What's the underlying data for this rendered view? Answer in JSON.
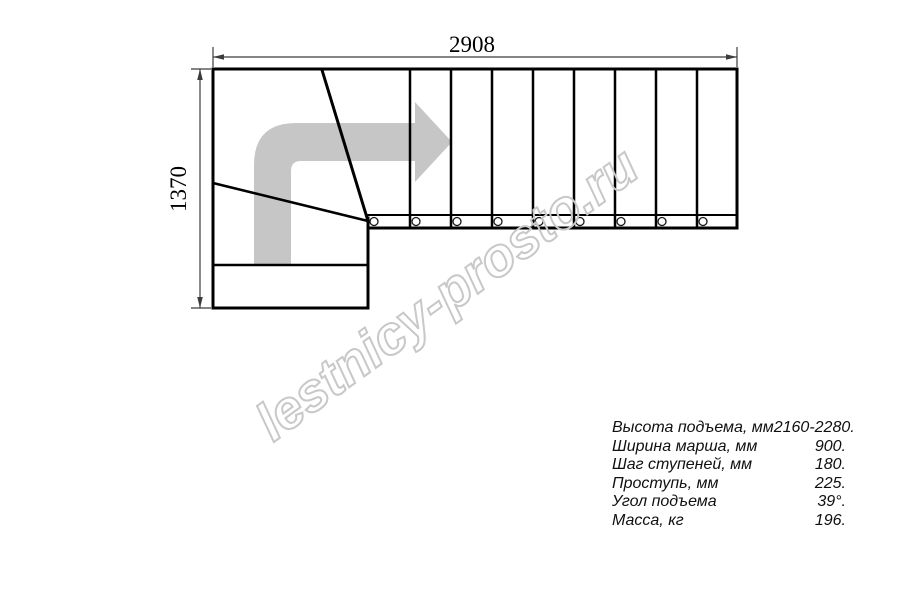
{
  "drawing": {
    "title": "staircase-plan-top-view",
    "width_label": "2908",
    "height_label": "1370",
    "tread_count": 9,
    "direction_arrow_icon": "turn-right-arrow",
    "colors": {
      "line": "#000000",
      "dimension": "#3c3c3c",
      "arrow_gray": "#c6c6c6",
      "watermark_gray": "#c8c8c8"
    }
  },
  "watermark": {
    "text": "lestnicy-prosto.ru"
  },
  "specs": {
    "rows": [
      {
        "label": "Высота подъема, мм",
        "value": "2160-2280."
      },
      {
        "label": "Ширина марша, мм",
        "value": "900."
      },
      {
        "label": "Шаг ступеней, мм",
        "value": "180."
      },
      {
        "label": "Проступь, мм",
        "value": "225."
      },
      {
        "label": "Угол подъема",
        "value": "39°."
      },
      {
        "label": "Масса, кг",
        "value": "196."
      }
    ]
  }
}
